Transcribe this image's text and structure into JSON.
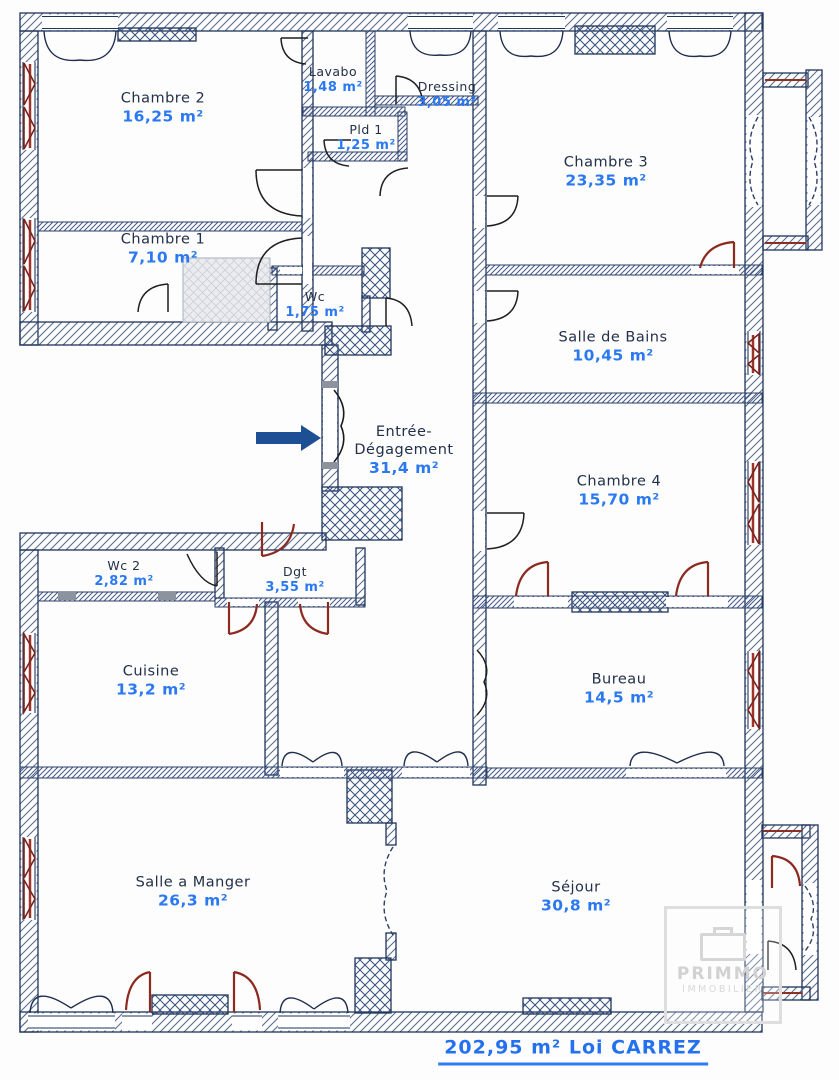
{
  "rooms": [
    {
      "name": "Chambre 2",
      "area": "16,25 m²"
    },
    {
      "name": "Lavabo",
      "area": "1,48 m²"
    },
    {
      "name": "Dressing",
      "area": "3,05 m²"
    },
    {
      "name": "Pld 1",
      "area": "1,25 m²"
    },
    {
      "name": "Chambre 3",
      "area": "23,35 m²"
    },
    {
      "name": "Chambre 1",
      "area": "7,10 m²"
    },
    {
      "name": "Wc",
      "area": "1,75 m²"
    },
    {
      "name": "Salle de Bains",
      "area": "10,45 m²"
    },
    {
      "name": "Entrée- Dégagement",
      "area": "31,4 m²"
    },
    {
      "name": "Chambre 4",
      "area": "15,70 m²"
    },
    {
      "name": "Wc 2",
      "area": "2,82 m²"
    },
    {
      "name": "Dgt",
      "area": "3,55 m²"
    },
    {
      "name": "Cuisine",
      "area": "13,2 m²"
    },
    {
      "name": "Bureau",
      "area": "14,5 m²"
    },
    {
      "name": "Salle a Manger",
      "area": "26,3 m²"
    },
    {
      "name": "Séjour",
      "area": "30,8 m²"
    }
  ],
  "total": {
    "label": "202,95 m² Loi CARREZ"
  },
  "watermark": {
    "line1": "PRIMMO",
    "line2": "IMMOBILIER"
  },
  "colors": {
    "area_text_blue": "#2b79f2",
    "total_text_blue": "#2471f0",
    "room_name_navy": "#223049",
    "wall_hatch_blue": "#5b6f92",
    "door_red": "#8c2a20",
    "arrow_blue": "#1d4f94"
  }
}
